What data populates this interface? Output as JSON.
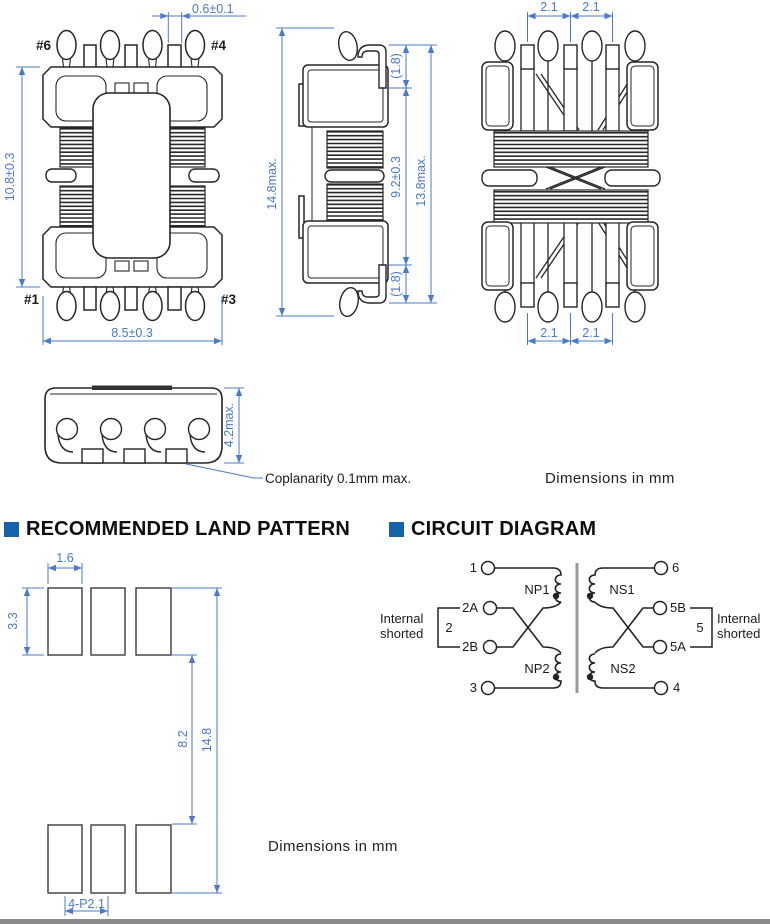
{
  "colors": {
    "dimension_blue": "#4b79cb",
    "drawing_line": "#262626",
    "header_bullet_blue": "#1663ad",
    "core_gray": "#999999"
  },
  "notes": {
    "dims_mm_top": "Dimensions in mm",
    "dims_mm_bottom": "Dimensions in mm",
    "coplanarity": "Coplanarity 0.1mm max."
  },
  "views": {
    "front": {
      "pin_labels": {
        "top_left": "#6",
        "top_right": "#4",
        "bottom_left": "#1",
        "bottom_right": "#3"
      },
      "dims": {
        "tab_width": "0.6±0.1",
        "height": "10.8±0.3",
        "width": "8.5±0.3"
      }
    },
    "side": {
      "dims": {
        "overall_height": "14.8max.",
        "lead_top": "(1.8)",
        "body_height": "9.2±0.3",
        "total_height": "13.8max.",
        "lead_bottom": "(1.8)"
      }
    },
    "back": {
      "dims": {
        "pitch_top": [
          "2.1",
          "2.1"
        ],
        "pitch_bottom": [
          "2.1",
          "2.1"
        ]
      }
    },
    "bottom": {
      "dims": {
        "height": "4.2max."
      }
    }
  },
  "land_pattern": {
    "header": "RECOMMENDED LAND PATTERN",
    "dims": {
      "pad_width": "1.6",
      "pad_height": "3.3",
      "row_gap": "8.2",
      "overall_height": "14.8",
      "pitch": "4-P2.1"
    }
  },
  "circuit": {
    "header": "CIRCUIT DIAGRAM",
    "terminals": {
      "t1": "1",
      "t2a": "2A",
      "t2b": "2B",
      "t3": "3",
      "t6": "6",
      "t5b": "5B",
      "t5a": "5A",
      "t4": "4"
    },
    "windings": {
      "np1": "NP1",
      "np2": "NP2",
      "ns1": "NS1",
      "ns2": "NS2"
    },
    "left_short": {
      "line1": "Internal",
      "line2": "shorted",
      "number": "2"
    },
    "right_short": {
      "line1": "Internal",
      "line2": "shorted",
      "number": "5"
    }
  }
}
